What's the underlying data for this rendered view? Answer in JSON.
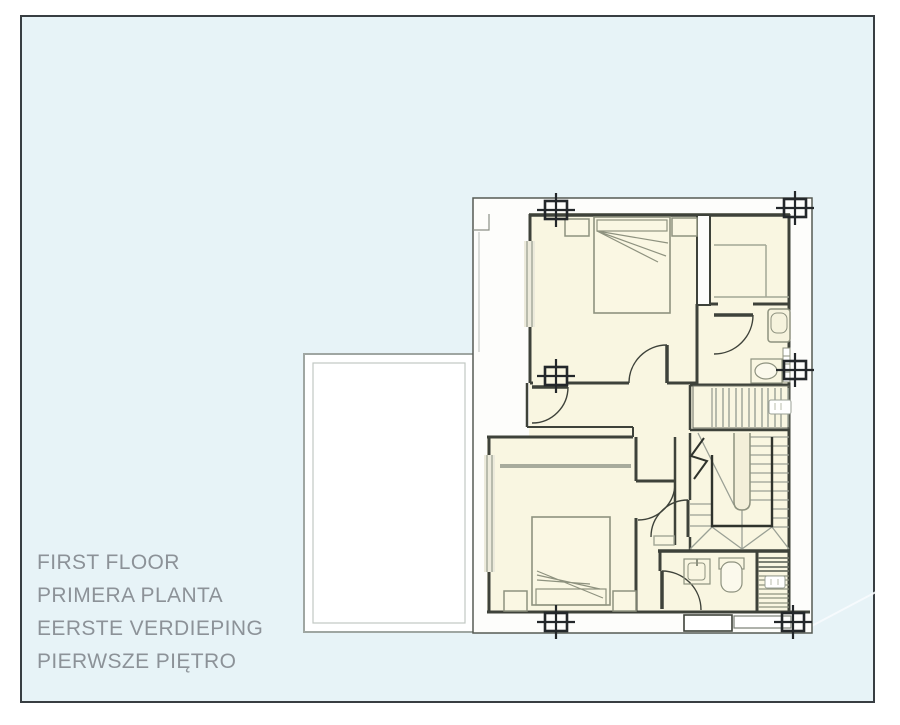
{
  "labels": {
    "en": "FIRST FLOOR",
    "es": "PRIMERA PLANTA",
    "nl": "EERSTE VERDIEPING",
    "pl": "PIERWSZE PIĘTRO"
  },
  "colors": {
    "page_background": "#ffffff",
    "panel_fill": "#e7f3f7",
    "panel_border": "#383e42",
    "plan_silhouette_fill": "#fdfdfb",
    "room_fill": "#f9f6e1",
    "wall": "#3e423a",
    "furniture_line": "#8e927f",
    "stair_tread_line": "#9aa095",
    "terrace_outline": "#9fa6a2",
    "column_marker": "#23272a",
    "label_text": "#8c9298"
  }
}
